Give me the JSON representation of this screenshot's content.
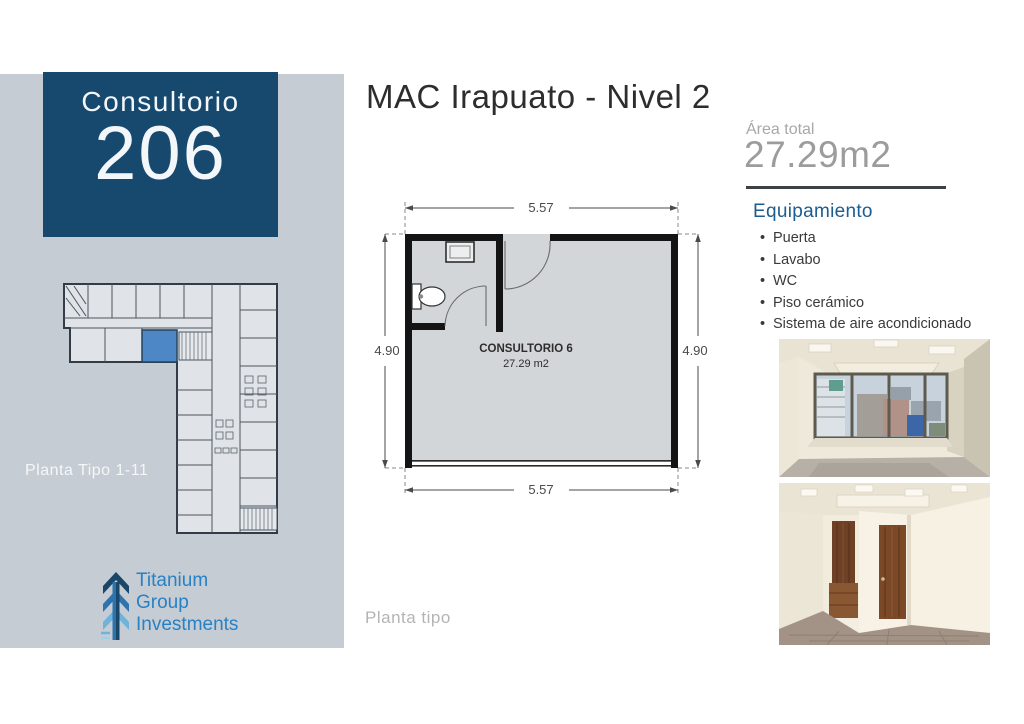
{
  "header": {
    "title": "MAC Irapuato - Nivel 2"
  },
  "sidebar": {
    "unit_label": "Consultorio",
    "unit_number": "206",
    "mini_plan_caption": "Planta Tipo 1-11",
    "logo": {
      "line1": "Titanium",
      "line2": "Group",
      "line3": "Investments"
    }
  },
  "floor_plan": {
    "room_name": "CONSULTORIO 6",
    "room_area": "27.29 m2",
    "dim_top": "5.57",
    "dim_bottom": "5.57",
    "dim_left": "4.90",
    "dim_right": "4.90",
    "caption": "Planta tipo"
  },
  "details": {
    "area_label": "Área total",
    "area_value": "27.29m2",
    "equipment_title": "Equipamiento",
    "equipment_items": [
      "Puerta",
      "Lavabo",
      "WC",
      "Piso cerámico",
      "Sistema de aire acondicionado"
    ]
  },
  "colors": {
    "sidebar_bg": "#c6ccd3",
    "navy_box": "#17496f",
    "accent_blue": "#1d5c8e",
    "logo_blue": "#2781c5",
    "highlight_room": "#4d87c5",
    "plan_floor": "#d3d6d9",
    "muted_gray": "#9c9c9c"
  }
}
